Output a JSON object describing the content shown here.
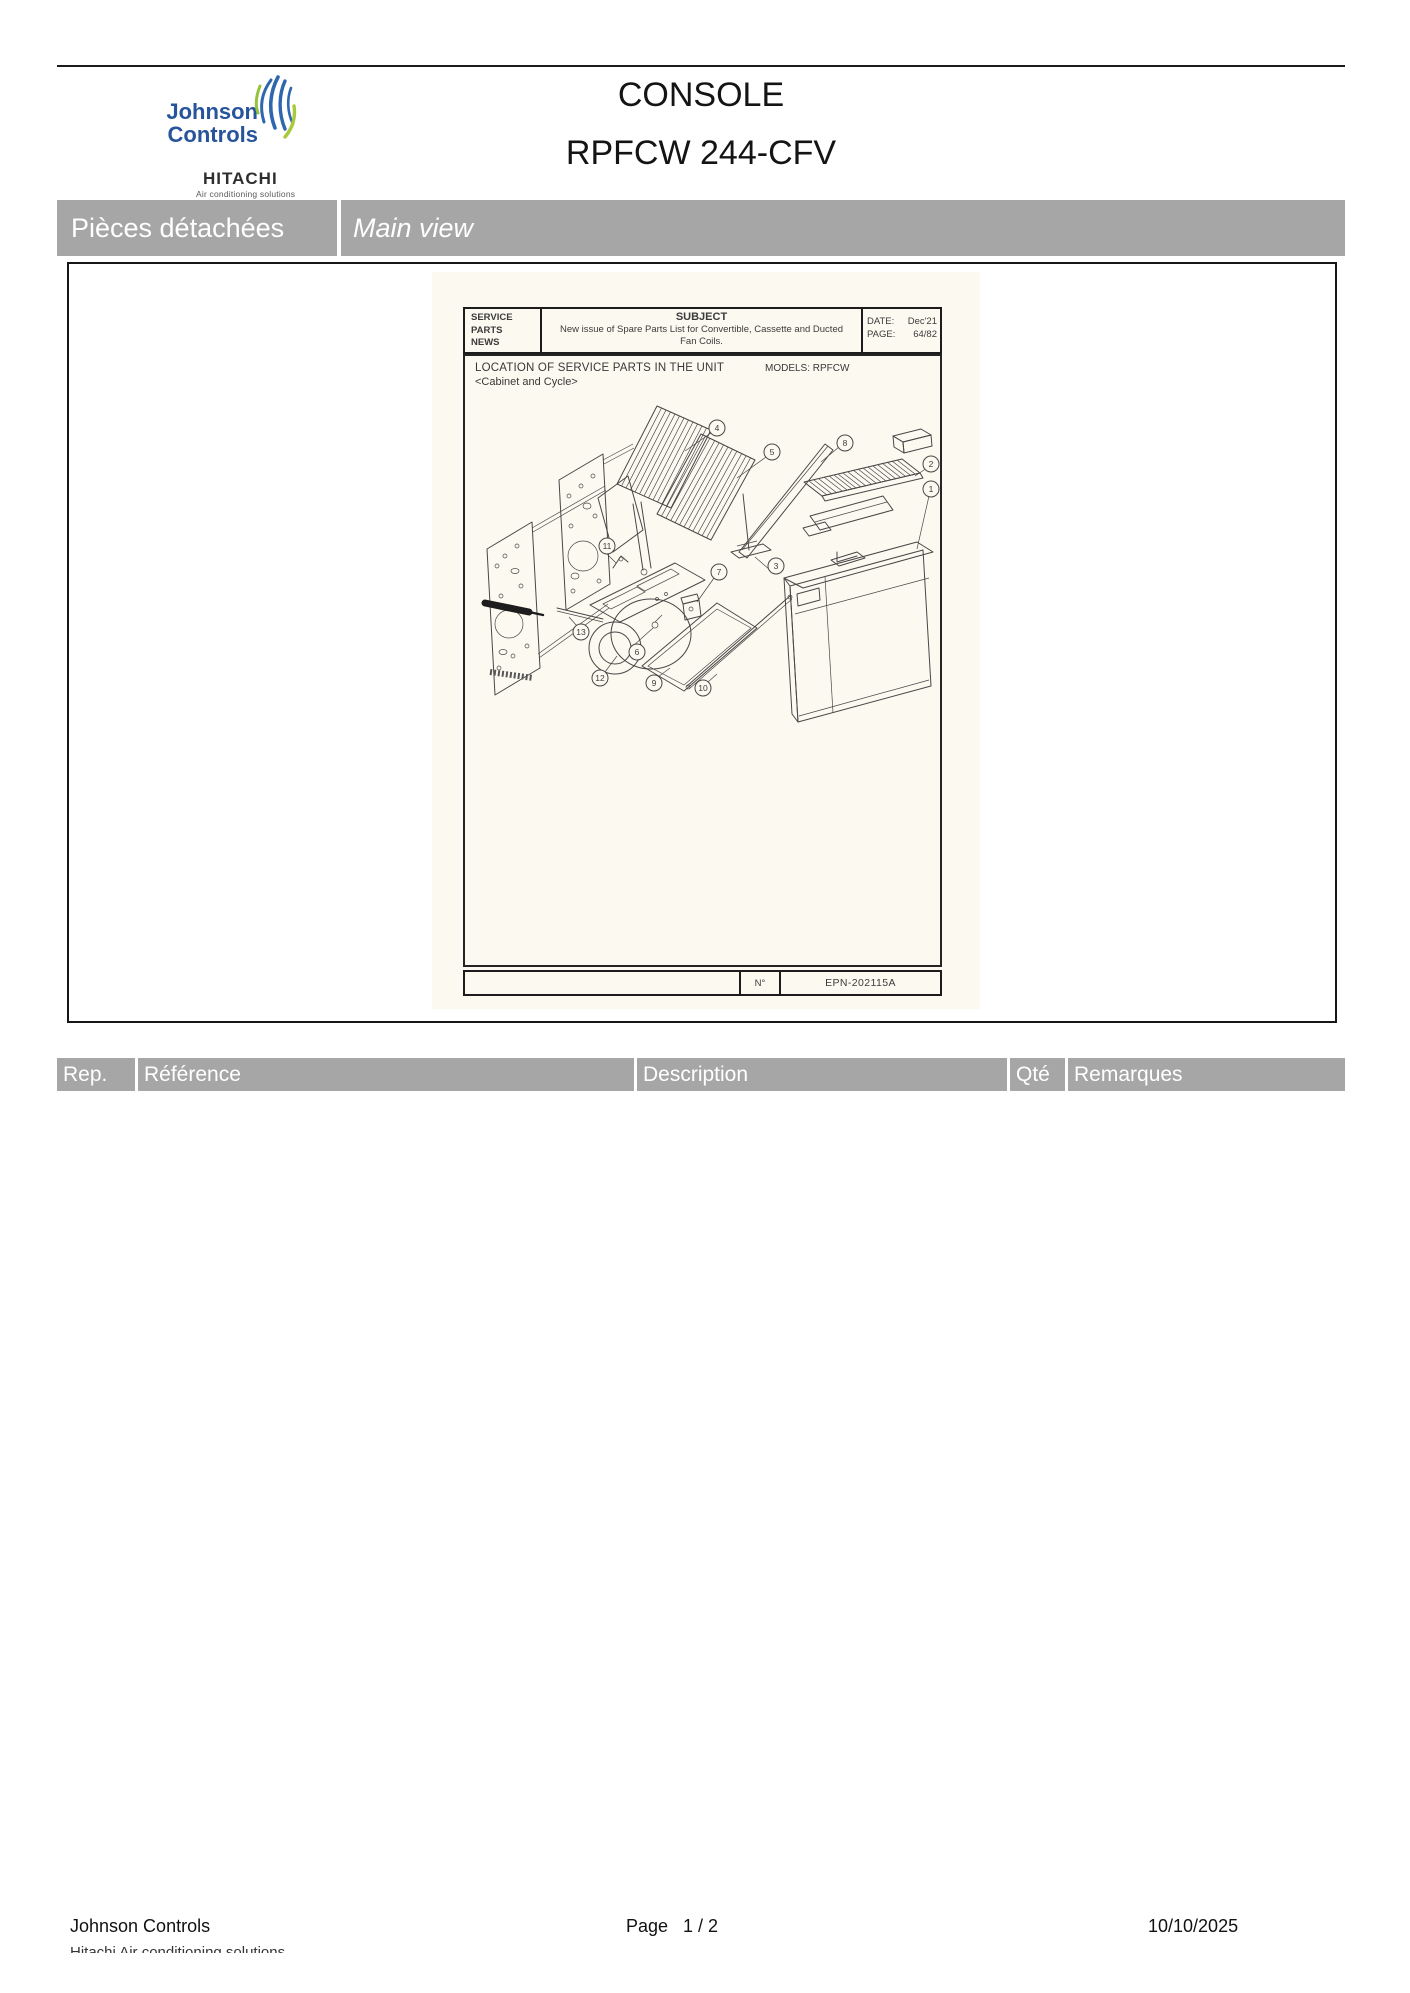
{
  "header": {
    "brand": {
      "line1": "Johnson",
      "line2": "Controls",
      "hitachi": "HITACHI",
      "hitachi_tagline": "Air conditioning solutions"
    },
    "title": "CONSOLE",
    "subtitle": "RPFCW 244-CFV"
  },
  "section_bar": {
    "left_label": "Pièces détachées",
    "right_label": "Main view"
  },
  "document": {
    "spn_header": {
      "left_lines": [
        "SERVICE",
        "PARTS",
        "NEWS"
      ],
      "subject_label": "SUBJECT",
      "subject_text": "New issue of Spare Parts List for Convertible, Cassette and Ducted Fan Coils.",
      "date_label": "DATE:",
      "date_value": "Dec'21",
      "page_label": "PAGE:",
      "page_value": "64/82"
    },
    "location_title": "LOCATION OF SERVICE PARTS IN THE UNIT",
    "location_subtitle": "<Cabinet and Cycle>",
    "models_label": "MODELS:  RPFCW",
    "callouts": [
      "1",
      "2",
      "3",
      "4",
      "5",
      "6",
      "7",
      "8",
      "9",
      "10",
      "11",
      "12",
      "13"
    ],
    "doc_footer": {
      "no_label": "N°",
      "epn": "EPN-202115A"
    }
  },
  "parts_table": {
    "columns": [
      "Rep.",
      "Référence",
      "Description",
      "Qté",
      "Remarques"
    ]
  },
  "page_footer": {
    "company": "Johnson Controls",
    "clipped_line": "Hitachi Air conditioning solutions",
    "page_label": "Page",
    "page_value": "1  /  2",
    "date": "10/10/2025"
  }
}
